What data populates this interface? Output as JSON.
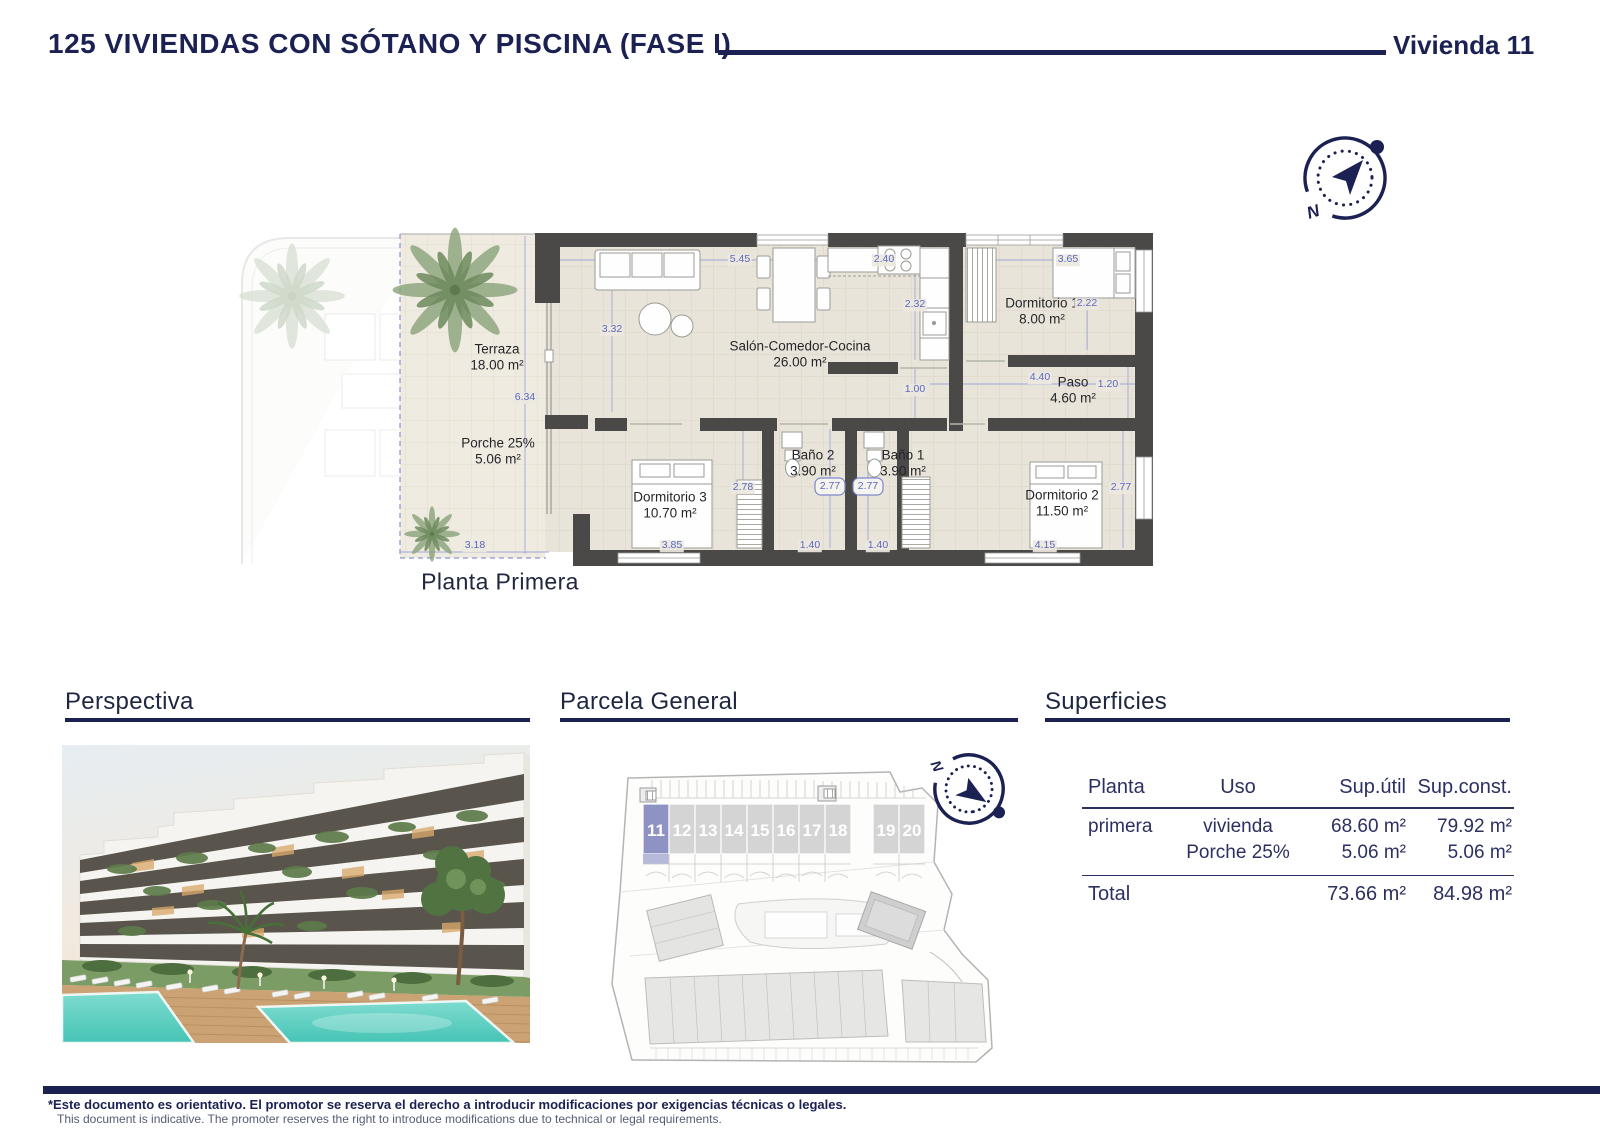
{
  "header": {
    "title": "125 VIVIENDAS CON SÓTANO Y PISCINA (FASE I)",
    "unit_label": "Vivienda 11"
  },
  "floor_plan": {
    "caption": "Planta Primera",
    "rooms": [
      {
        "name": "Terraza",
        "area": "18.00 m²"
      },
      {
        "name": "Porche 25%",
        "area": "5.06 m²"
      },
      {
        "name": "Salón-Comedor-Cocina",
        "area": "26.00 m²"
      },
      {
        "name": "Dormitorio 1",
        "area": "8.00 m²"
      },
      {
        "name": "Paso",
        "area": "4.60 m²"
      },
      {
        "name": "Dormitorio 2",
        "area": "11.50 m²"
      },
      {
        "name": "Dormitorio 3",
        "area": "10.70 m²"
      },
      {
        "name": "Baño 2",
        "area": "3.90 m²"
      },
      {
        "name": "Baño 1",
        "area": "3.90 m²"
      }
    ],
    "dimensions": [
      "5.45",
      "2.40",
      "3.65",
      "3.32",
      "2.32",
      "2.22",
      "6.34",
      "1.00",
      "4.40",
      "1.20",
      "2.78",
      "2.77",
      "2.77",
      "2.77",
      "3.18",
      "3.85",
      "1.40",
      "1.40",
      "4.15"
    ]
  },
  "sections": {
    "perspectiva": {
      "heading": "Perspectiva"
    },
    "parcela": {
      "heading": "Parcela General",
      "units": [
        "11",
        "12",
        "13",
        "14",
        "15",
        "16",
        "17",
        "18",
        "19",
        "20"
      ],
      "highlighted_unit": "11"
    },
    "superficies": {
      "heading": "Superficies",
      "columns": [
        "Planta",
        "Uso",
        "Sup.útil",
        "Sup.const."
      ],
      "rows": [
        {
          "planta": "primera",
          "uso": "vivienda",
          "sup_util": "68.60 m²",
          "sup_const": "79.92 m²"
        },
        {
          "planta": "",
          "uso": "Porche 25%",
          "sup_util": "5.06 m²",
          "sup_const": "5.06 m²"
        }
      ],
      "total": {
        "label": "Total",
        "sup_util": "73.66 m²",
        "sup_const": "84.98 m²"
      }
    }
  },
  "footer": {
    "disclaimer_es": "*Este documento es orientativo. El promotor se reserva el derecho a introducir modificaciones por exigencias técnicas o legales.",
    "disclaimer_en": "This document is indicative. The promoter reserves the right to introduce modifications due to technical or legal requirements."
  },
  "colors": {
    "navy": "#1b2153",
    "dimension_blue": "#5c68be",
    "wall_gray": "#4a4947",
    "floor_beige": "#e9e4d9",
    "highlight_purple": "#8e93c4",
    "pool_turquoise": "#5ed0c4"
  }
}
